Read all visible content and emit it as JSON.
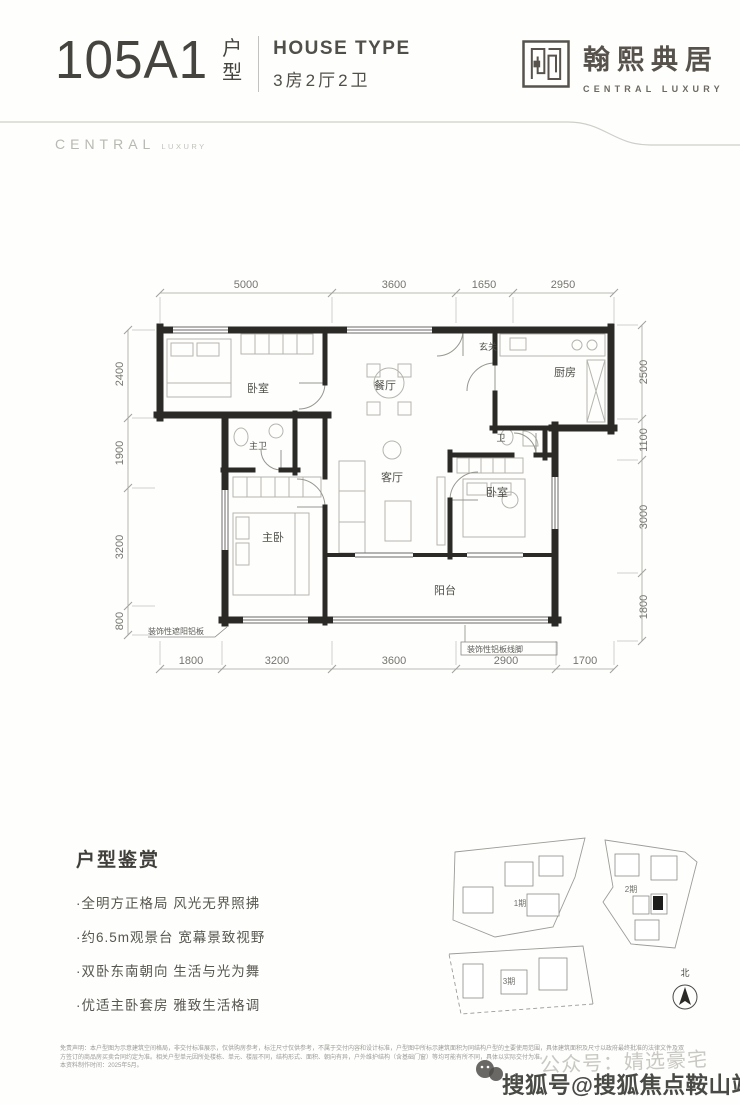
{
  "header": {
    "number": "105",
    "variant": "A1",
    "unit_char_1": "户",
    "unit_char_2": "型",
    "house_type_en": "HOUSE TYPE",
    "house_type_cn": "3房2厅2卫"
  },
  "brand": {
    "name_cn": "翰熙典居",
    "name_en": "CENTRAL LUXURY",
    "band_main": "CENTRAL",
    "band_sub": "LUXURY"
  },
  "plan": {
    "rooms": {
      "bedroom1": "卧室",
      "dining": "餐厅",
      "entry": "玄关",
      "kitchen": "厨房",
      "master_bath": "主卫",
      "bath": "卫",
      "living": "客厅",
      "bedroom2": "卧室",
      "master_bedroom": "主卧",
      "balcony": "阳台"
    },
    "dims": {
      "top": [
        "5000",
        "3600",
        "1650",
        "2950"
      ],
      "left": [
        "2400",
        "1900",
        "3200",
        "800"
      ],
      "right": [
        "2500",
        "1100",
        "3000",
        "1800"
      ],
      "bottom": [
        "1800",
        "3200",
        "3600",
        "2900",
        "1700"
      ]
    },
    "callouts": {
      "left": "装饰性遮阳铝板",
      "right": "装饰性铝板线脚"
    }
  },
  "features": {
    "title": "户型鉴赏",
    "items": [
      "·全明方正格局 风光无界照拂",
      "·约6.5m观景台 宽幕景致视野",
      "·双卧东南朝向 生活与光为舞",
      "·优适主卧套房 雅致生活格调"
    ]
  },
  "site_plan": {
    "parcel1": "1期",
    "parcel2": "2期",
    "parcel3": "3期",
    "north_label": "北"
  },
  "disclaimer": {
    "line1": "免责声明：本户型图为示意建筑空间格局，非交付标准展示，仅供购房参考，标注尺寸仅供参考，不属于交付内容和设计标准，户型图中所标示建筑面积为同结构户型的主要使用范围，具体建筑面积及尺寸以政府最终批准的法律文件及双",
    "line2": "方签订的商品房买卖合同约定为准。相关户型单元因所处楼栋、单元、楼层不同，结构形式、面积、朝向有异，户外维护结构（含基础门窗）等均可能有所不同，具体以实际交付为准。",
    "line3": "本资料制作时间：2025年5月。"
  },
  "watermarks": {
    "account": "公众号：婧选豪宅",
    "sohu": "搜狐号@搜狐焦点鞍山站"
  },
  "colors": {
    "wall": "#2b2a27",
    "accent": "#45443f",
    "dim_text": "#75746f",
    "highlight": "#1d1d1b"
  }
}
